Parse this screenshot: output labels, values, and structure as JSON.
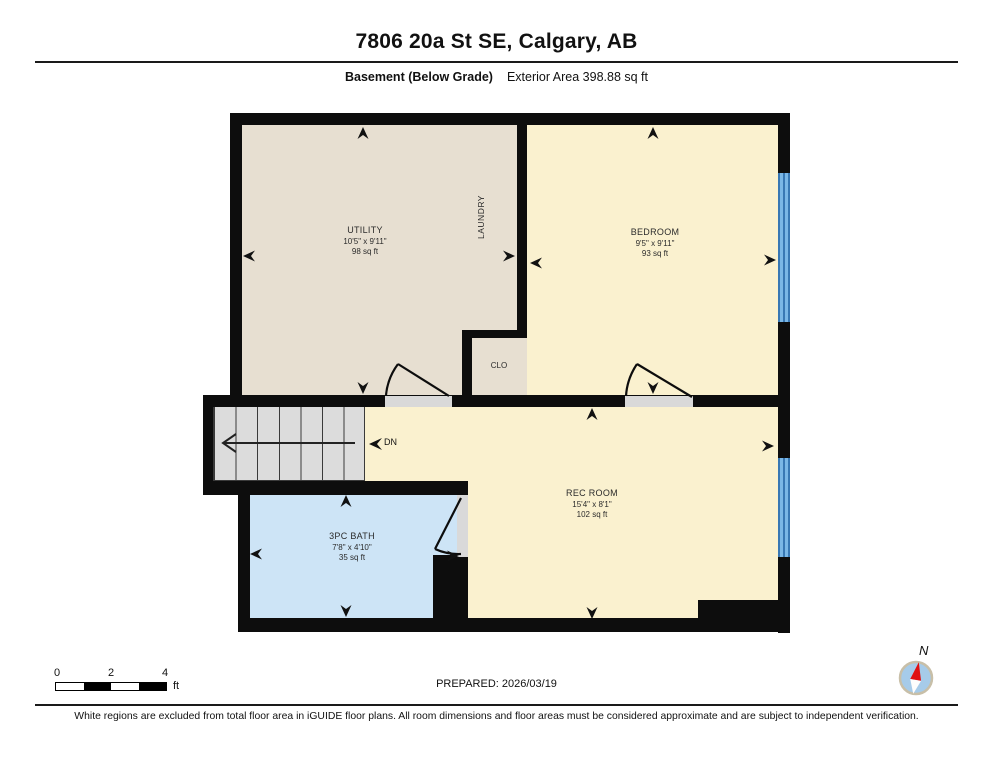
{
  "header": {
    "title": "7806 20a St SE, Calgary, AB",
    "floor_label": "Basement (Below Grade)",
    "area_label": "Exterior Area 398.88 sq ft"
  },
  "plan": {
    "rooms": {
      "utility": {
        "name": "UTILITY",
        "dims": "10'5\" x 9'11\"",
        "area": "98 sq ft"
      },
      "laundry": {
        "name": "LAUNDRY"
      },
      "bedroom": {
        "name": "BEDROOM",
        "dims": "9'5\" x 9'11\"",
        "area": "93 sq ft"
      },
      "closet": {
        "name": "CLO"
      },
      "rec_room": {
        "name": "REC ROOM",
        "dims": "15'4\" x 8'1\"",
        "area": "102 sq ft"
      },
      "bath": {
        "name": "3PC BATH",
        "dims": "7'8\" x 4'10\"",
        "area": "35 sq ft"
      }
    },
    "stairs_label": "DN",
    "colors": {
      "wall": "#0d0d0d",
      "room_tan": "#e7dfd1",
      "room_yellow": "#faf1cf",
      "room_blue": "#cde4f6",
      "stairs_gray": "#dcdcdc",
      "window_blue": "#7ab7e6",
      "compass_needle_red": "#e01111"
    }
  },
  "footer": {
    "scale": {
      "ticks": [
        "0",
        "2",
        "4"
      ],
      "unit": "ft"
    },
    "prepared": "PREPARED: 2026/03/19",
    "compass_label": "N",
    "disclaimer": "White regions are excluded from total floor area in iGUIDE floor plans. All room dimensions and floor areas must be considered approximate and are subject to independent verification."
  }
}
